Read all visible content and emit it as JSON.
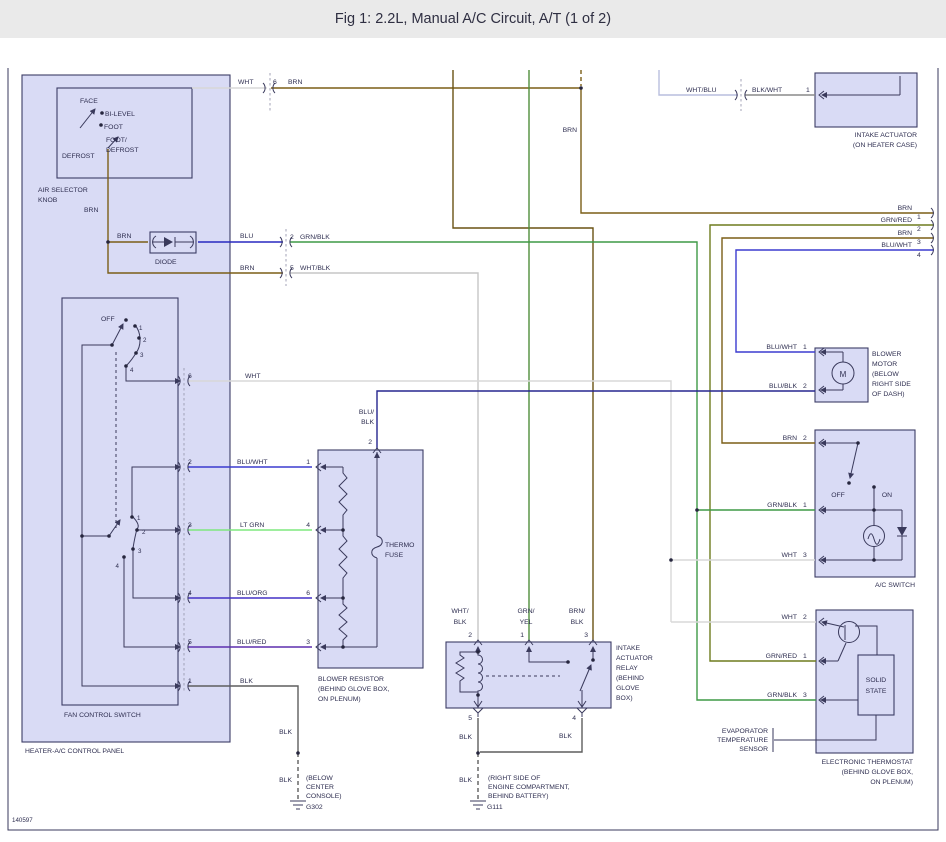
{
  "title": "Fig 1: 2.2L, Manual A/C Circuit, A/T (1 of 2)",
  "ref": "140597",
  "colors": {
    "ink": "#3a3a5c",
    "text": "#2e2e50",
    "panel": "#d9dbf5",
    "box": "#d9dbf5",
    "border": "#3c3c66",
    "title_bg": "#eaeaea",
    "brn": "#7b5e17",
    "wht": "#d8d8d8",
    "blu": "#2929c0",
    "blk": "#5e5e5e",
    "grn_blk": "#3f9a46",
    "wht_blk": "#c6c6c6",
    "blu_wht": "#3b3bcf",
    "lt_grn": "#7fe87f",
    "blu_org": "#4431c5",
    "blu_red": "#5d2fae",
    "blu_blk": "#26268f",
    "grn_red": "#6e7c1e",
    "grn_yel": "#4f8f3c",
    "brn_blk": "#6a5213",
    "wht_blu": "#b9bede",
    "blk_wht": "#8a8a8a"
  },
  "air": {
    "face": "FACE",
    "bilevel": "BI-LEVEL",
    "foot": "FOOT",
    "footdef1": "FOOT/",
    "footdef2": "DEFROST",
    "defrost": "DEFROST",
    "name1": "AIR SELECTOR",
    "name2": "KNOB"
  },
  "panel_label": "HEATER-A/C CONTROL PANEL",
  "fan": {
    "off": "OFF",
    "n1": "1",
    "n2": "2",
    "n3": "3",
    "n4": "4",
    "name": "FAN CONTROL SWITCH"
  },
  "diode_label": "DIODE",
  "wl": {
    "wht": "WHT",
    "brn": "BRN",
    "blu": "BLU",
    "blk": "BLK",
    "grnblk": "GRN/BLK",
    "whtblk": "WHT/BLK",
    "bluwht": "BLU/WHT",
    "ltgrn": "LT GRN",
    "bluorg": "BLU/ORG",
    "blured": "BLU/RED",
    "blublk": "BLU/BLK",
    "grnred": "GRN/RED",
    "whtblu": "WHT/BLU",
    "blkwht": "BLK/WHT",
    "blu_": "BLU/",
    "blk_": "BLK",
    "wht_": "WHT/",
    "grn_": "GRN/",
    "yel": "YEL",
    "brn_": "BRN/"
  },
  "pins": {
    "n1": "1",
    "n2": "2",
    "n3": "3",
    "n4": "4",
    "n5": "5",
    "n6": "6"
  },
  "res": {
    "thermo": "THERMO",
    "fuse": "FUSE",
    "name1": "BLOWER RESISTOR",
    "name2": "(BEHIND GLOVE BOX,",
    "name3": "ON PLENUM)"
  },
  "relay": {
    "name1": "INTAKE",
    "name2": "ACTUATOR",
    "name3": "RELAY",
    "name4": "(BEHIND",
    "name5": "GLOVE",
    "name6": "BOX)"
  },
  "gnd": {
    "g302": "G302",
    "loc302_1": "(BELOW",
    "loc302_2": "CENTER",
    "loc302_3": "CONSOLE)",
    "g111": "G111",
    "loc111_1": "(RIGHT SIDE OF",
    "loc111_2": "ENGINE COMPARTMENT,",
    "loc111_3": "BEHIND BATTERY)"
  },
  "iact": {
    "name1": "INTAKE ACTUATOR",
    "name2": "(ON HEATER CASE)"
  },
  "motor": {
    "m": "M",
    "name1": "BLOWER",
    "name2": "MOTOR",
    "name3": "(BELOW",
    "name4": "RIGHT SIDE",
    "name5": "OF DASH)"
  },
  "ac": {
    "off": "OFF",
    "on": "ON",
    "name": "A/C SWITCH"
  },
  "therm": {
    "solid": "SOLID",
    "state": "STATE",
    "name1": "ELECTRONIC THERMOSTAT",
    "name2": "(BEHIND GLOVE BOX,",
    "name3": "ON PLENUM)"
  },
  "evap": {
    "l1": "EVAPORATOR",
    "l2": "TEMPERATURE",
    "l3": "SENSOR"
  }
}
